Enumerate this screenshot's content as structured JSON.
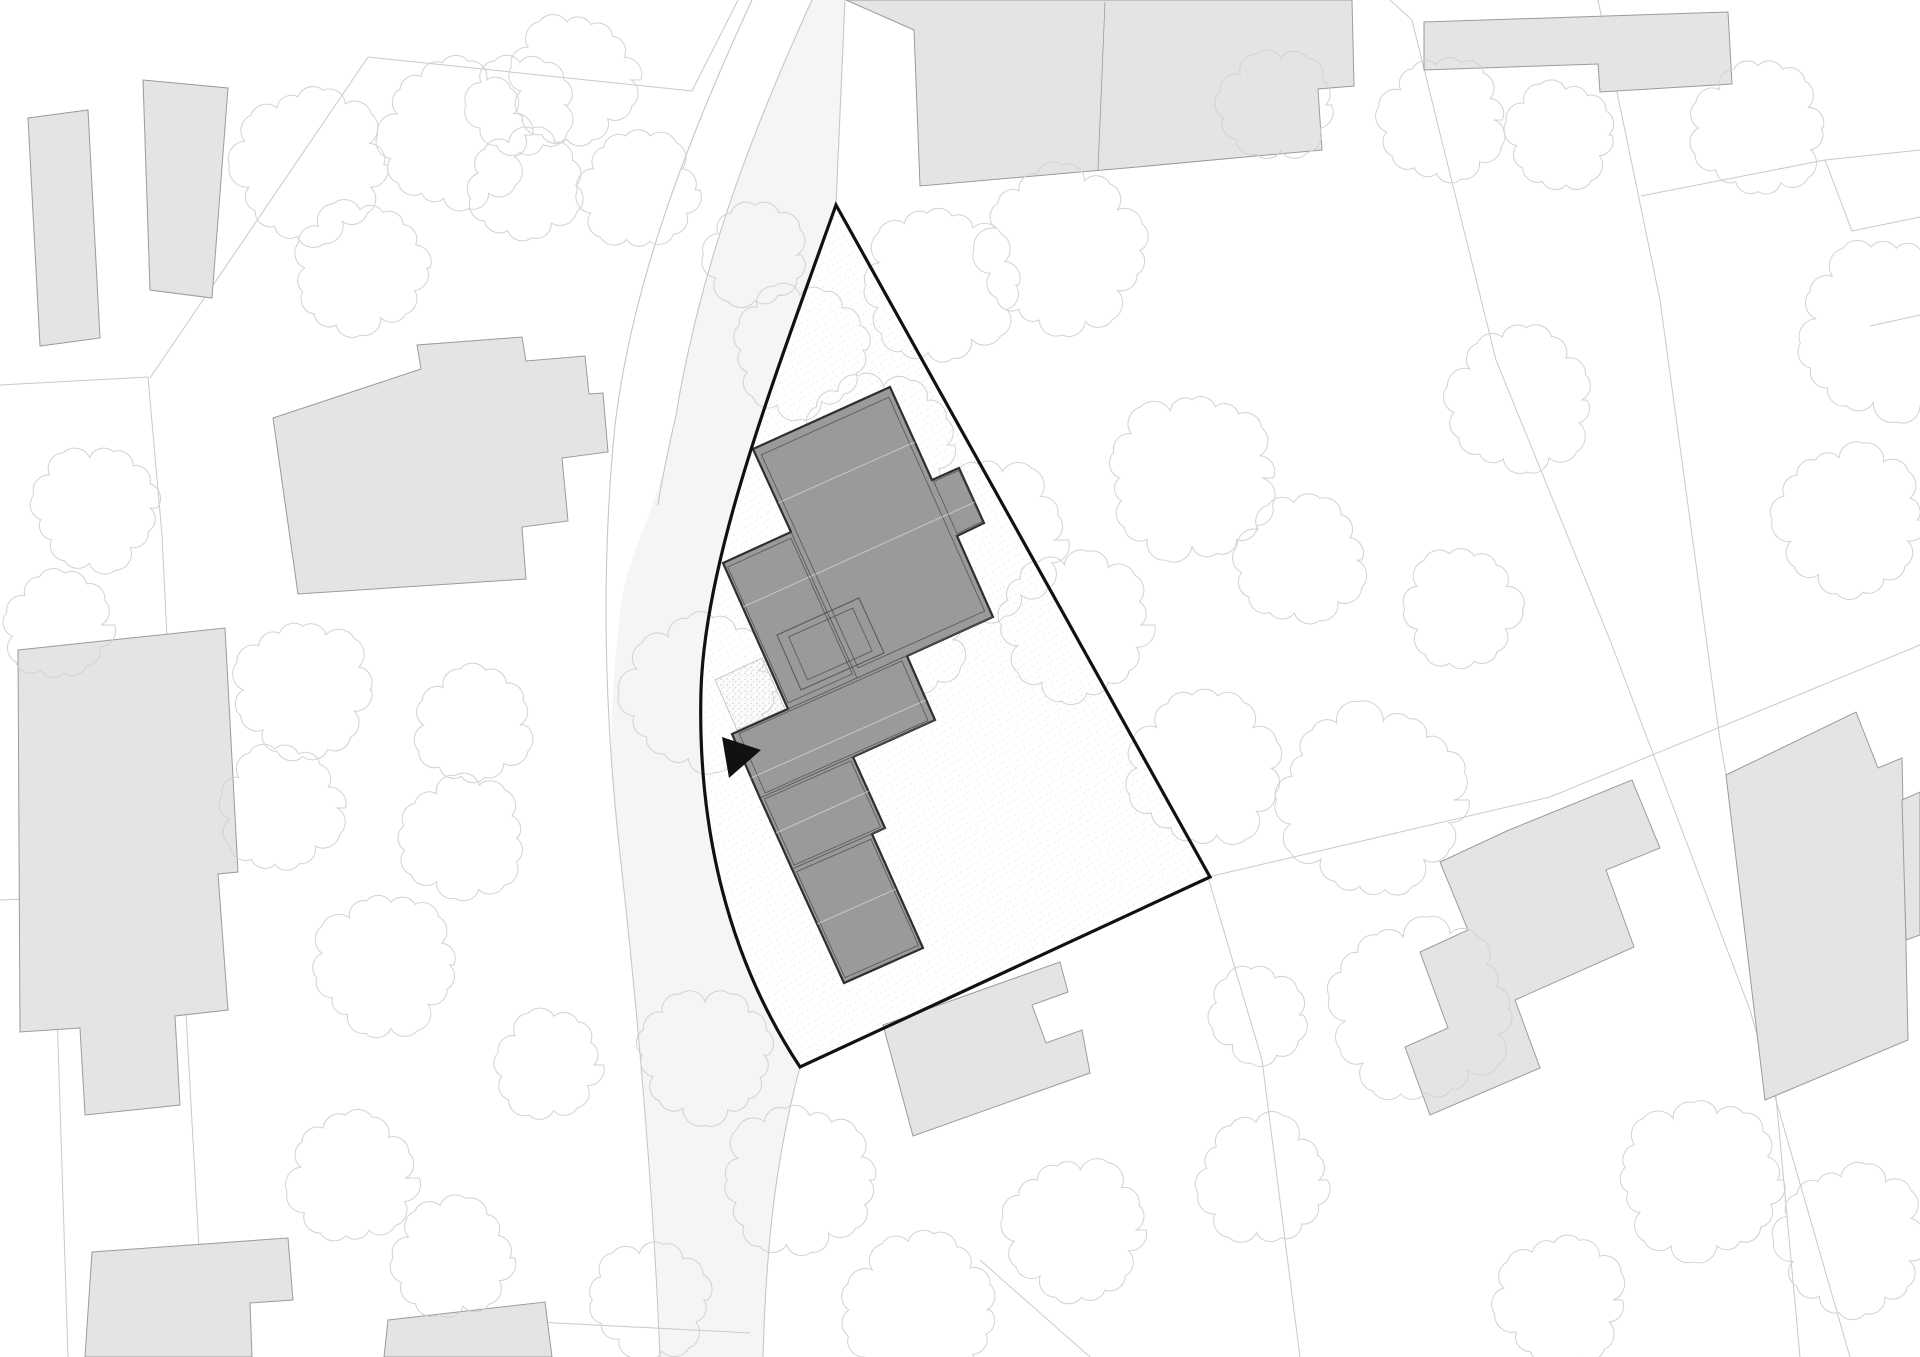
{
  "document": {
    "type": "architectural-site-plan",
    "canvas": {
      "width": 1920,
      "height": 1357
    }
  },
  "colors": {
    "background": "#ffffff",
    "road_fill": "#f5f5f5",
    "road_edge": "#c6c6c6",
    "parcel_line": "#c9c9c9",
    "context_building_fill": "#e4e4e4",
    "context_building_stroke": "#9b9b9b",
    "tree_stroke": "#d2d2d2",
    "site_boundary": "#111111",
    "main_building_fill": "#9a9a9a",
    "main_building_stroke": "#2f2f2f",
    "main_building_inner": "#555555",
    "roof_highlight": "rgba(255,255,255,0.45)",
    "stipple_dot": "#a9a9a9",
    "terrace_stroke": "#bdbdbd",
    "marker": "#111111"
  },
  "map": {
    "road": {
      "fill_path": "M 812,0 C 748,140 700,270 676,415 C 656,520 630,545 621,605 C 610,700 607,765 620,848 C 636,988 654,1180 661,1357 L 763,1357 C 766,1250 775,1160 800,1067 C 716,940 698,800 701,690 C 705,560 770,390 836,205 L 845,0 Z",
      "edge_paths": [
        "M 752,0 C 685,145 632,285 615,425 C 601,565 604,705 619,845 C 635,985 653,1180 660,1357",
        "M 812,0 C 748,140 700,270 676,415 C 668,450 662,480 658,505",
        "M 845,0 L 836,205",
        "M 800,1067 C 775,1160 766,1250 763,1357"
      ]
    },
    "parcel_lines": [
      [
        [
          368,
          57
        ],
        [
          692,
          91
        ]
      ],
      [
        [
          692,
          91
        ],
        [
          738,
          0
        ]
      ],
      [
        [
          150,
          378
        ],
        [
          368,
          57
        ]
      ],
      [
        [
          0,
          385
        ],
        [
          148,
          377
        ],
        [
          162,
          535
        ],
        [
          180,
          905
        ],
        [
          205,
          1357
        ]
      ],
      [
        [
          0,
          900
        ],
        [
          162,
          893
        ]
      ],
      [
        [
          55,
          948
        ],
        [
          68,
          1357
        ]
      ],
      [
        [
          1390,
          0
        ],
        [
          1412,
          20
        ],
        [
          1496,
          360
        ],
        [
          1610,
          640
        ],
        [
          1750,
          1010
        ],
        [
          1850,
          1357
        ]
      ],
      [
        [
          1598,
          0
        ],
        [
          1660,
          300
        ],
        [
          1720,
          740
        ],
        [
          1768,
          1010
        ],
        [
          1800,
          1357
        ]
      ],
      [
        [
          1641,
          196
        ],
        [
          1825,
          160
        ],
        [
          1920,
          150
        ]
      ],
      [
        [
          1825,
          160
        ],
        [
          1852,
          231
        ],
        [
          1920,
          217
        ]
      ],
      [
        [
          1870,
          326
        ],
        [
          1920,
          315
        ]
      ],
      [
        [
          1208,
          877
        ],
        [
          1550,
          797
        ],
        [
          1920,
          645
        ]
      ],
      [
        [
          1208,
          877
        ],
        [
          1262,
          1060
        ],
        [
          1300,
          1357
        ]
      ],
      [
        [
          980,
          1260
        ],
        [
          1090,
          1357
        ]
      ],
      [
        [
          460,
          1318
        ],
        [
          750,
          1333
        ]
      ]
    ],
    "context_buildings": [
      {
        "points": [
          [
            28,
            118
          ],
          [
            88,
            110
          ],
          [
            100,
            338
          ],
          [
            40,
            346
          ]
        ]
      },
      {
        "points": [
          [
            143,
            80
          ],
          [
            228,
            88
          ],
          [
            212,
            298
          ],
          [
            150,
            290
          ]
        ]
      },
      {
        "points": [
          [
            273,
            418
          ],
          [
            421,
            369
          ],
          [
            417,
            345
          ],
          [
            522,
            337
          ],
          [
            526,
            361
          ],
          [
            585,
            356
          ],
          [
            589,
            394
          ],
          [
            603,
            393
          ],
          [
            608,
            452
          ],
          [
            562,
            458
          ],
          [
            568,
            521
          ],
          [
            522,
            527
          ],
          [
            526,
            579
          ],
          [
            420,
            586
          ],
          [
            298,
            594
          ]
        ]
      },
      {
        "points": [
          [
            18,
            650
          ],
          [
            225,
            628
          ],
          [
            238,
            872
          ],
          [
            218,
            874
          ],
          [
            228,
            1010
          ],
          [
            175,
            1016
          ],
          [
            180,
            1105
          ],
          [
            85,
            1115
          ],
          [
            80,
            1028
          ],
          [
            20,
            1032
          ]
        ]
      },
      {
        "points": [
          [
            92,
            1252
          ],
          [
            288,
            1238
          ],
          [
            293,
            1300
          ],
          [
            250,
            1303
          ],
          [
            252,
            1357
          ],
          [
            85,
            1357
          ]
        ]
      },
      {
        "points": [
          [
            388,
            1320
          ],
          [
            545,
            1302
          ],
          [
            552,
            1357
          ],
          [
            384,
            1357
          ]
        ]
      },
      {
        "points": [
          [
            883,
            1025
          ],
          [
            1060,
            962
          ],
          [
            1068,
            992
          ],
          [
            1032,
            1005
          ],
          [
            1046,
            1043
          ],
          [
            1082,
            1030
          ],
          [
            1090,
            1073
          ],
          [
            913,
            1136
          ]
        ]
      },
      {
        "points": [
          [
            846,
            0
          ],
          [
            1352,
            0
          ],
          [
            1354,
            86
          ],
          [
            1318,
            89
          ],
          [
            1322,
            150
          ],
          [
            1126,
            168
          ],
          [
            920,
            186
          ],
          [
            914,
            30
          ]
        ]
      },
      {
        "points": [
          [
            1424,
            22
          ],
          [
            1728,
            12
          ],
          [
            1732,
            84
          ],
          [
            1600,
            92
          ],
          [
            1598,
            64
          ],
          [
            1424,
            70
          ]
        ]
      },
      {
        "points": [
          [
            1509,
            830
          ],
          [
            1632,
            780
          ],
          [
            1660,
            848
          ],
          [
            1606,
            870
          ],
          [
            1634,
            947
          ],
          [
            1515,
            1000
          ],
          [
            1540,
            1068
          ],
          [
            1430,
            1115
          ],
          [
            1405,
            1047
          ],
          [
            1448,
            1028
          ],
          [
            1420,
            952
          ],
          [
            1468,
            930
          ],
          [
            1440,
            862
          ]
        ]
      },
      {
        "points": [
          [
            1726,
            775
          ],
          [
            1856,
            712
          ],
          [
            1878,
            768
          ],
          [
            1902,
            758
          ],
          [
            1908,
            1040
          ],
          [
            1765,
            1100
          ]
        ]
      },
      {
        "points": [
          [
            1902,
            800
          ],
          [
            1920,
            792
          ],
          [
            1920,
            935
          ],
          [
            1906,
            940
          ]
        ]
      }
    ],
    "context_building_inner_lines": [
      [
        [
          1105,
          2
        ],
        [
          1098,
          170
        ]
      ]
    ],
    "trees": [
      {
        "cx": 310,
        "cy": 165,
        "r": 72
      },
      {
        "cx": 455,
        "cy": 135,
        "r": 70
      },
      {
        "cx": 360,
        "cy": 268,
        "r": 62
      },
      {
        "cx": 520,
        "cy": 105,
        "r": 48
      },
      {
        "cx": 573,
        "cy": 80,
        "r": 60
      },
      {
        "cx": 525,
        "cy": 185,
        "r": 52
      },
      {
        "cx": 638,
        "cy": 190,
        "r": 55
      },
      {
        "cx": 800,
        "cy": 350,
        "r": 62
      },
      {
        "cx": 755,
        "cy": 255,
        "r": 48
      },
      {
        "cx": 940,
        "cy": 285,
        "r": 72
      },
      {
        "cx": 1062,
        "cy": 250,
        "r": 78
      },
      {
        "cx": 878,
        "cy": 445,
        "r": 68
      },
      {
        "cx": 985,
        "cy": 540,
        "r": 75
      },
      {
        "cx": 1075,
        "cy": 625,
        "r": 70
      },
      {
        "cx": 905,
        "cy": 640,
        "r": 55
      },
      {
        "cx": 1275,
        "cy": 105,
        "r": 52
      },
      {
        "cx": 1442,
        "cy": 120,
        "r": 58
      },
      {
        "cx": 1560,
        "cy": 135,
        "r": 50
      },
      {
        "cx": 1758,
        "cy": 128,
        "r": 62
      },
      {
        "cx": 1192,
        "cy": 478,
        "r": 78
      },
      {
        "cx": 1300,
        "cy": 560,
        "r": 60
      },
      {
        "cx": 1520,
        "cy": 400,
        "r": 68
      },
      {
        "cx": 1890,
        "cy": 330,
        "r": 85
      },
      {
        "cx": 1850,
        "cy": 520,
        "r": 70
      },
      {
        "cx": 1205,
        "cy": 768,
        "r": 72
      },
      {
        "cx": 1372,
        "cy": 800,
        "r": 88
      },
      {
        "cx": 1462,
        "cy": 608,
        "r": 55
      },
      {
        "cx": 700,
        "cy": 692,
        "r": 72
      },
      {
        "cx": 95,
        "cy": 508,
        "r": 58
      },
      {
        "cx": 58,
        "cy": 625,
        "r": 50
      },
      {
        "cx": 303,
        "cy": 690,
        "r": 64
      },
      {
        "cx": 281,
        "cy": 808,
        "r": 58
      },
      {
        "cx": 473,
        "cy": 725,
        "r": 54
      },
      {
        "cx": 462,
        "cy": 838,
        "r": 58
      },
      {
        "cx": 385,
        "cy": 965,
        "r": 66
      },
      {
        "cx": 548,
        "cy": 1065,
        "r": 50
      },
      {
        "cx": 352,
        "cy": 1178,
        "r": 60
      },
      {
        "cx": 452,
        "cy": 1258,
        "r": 56
      },
      {
        "cx": 705,
        "cy": 1055,
        "r": 62
      },
      {
        "cx": 798,
        "cy": 1180,
        "r": 70
      },
      {
        "cx": 920,
        "cy": 1310,
        "r": 72
      },
      {
        "cx": 1075,
        "cy": 1230,
        "r": 66
      },
      {
        "cx": 650,
        "cy": 1300,
        "r": 55
      },
      {
        "cx": 1262,
        "cy": 1180,
        "r": 60
      },
      {
        "cx": 1420,
        "cy": 1010,
        "r": 85
      },
      {
        "cx": 1700,
        "cy": 1180,
        "r": 75
      },
      {
        "cx": 1560,
        "cy": 1300,
        "r": 60
      },
      {
        "cx": 1852,
        "cy": 1240,
        "r": 70
      },
      {
        "cx": 1258,
        "cy": 1015,
        "r": 45
      }
    ],
    "site": {
      "boundary_path": "M 836,205 L 1210,877 L 800,1067 C 716,940 698,800 701,690 C 705,560 770,390 836,205 Z",
      "boundary_width": 3.2
    },
    "main_building": {
      "outline": [
        [
          890,
          387
        ],
        [
          932,
          480
        ],
        [
          959,
          468
        ],
        [
          984,
          523
        ],
        [
          957,
          536
        ],
        [
          993,
          617
        ],
        [
          907,
          656
        ],
        [
          935,
          720
        ],
        [
          853,
          757
        ],
        [
          885,
          828
        ],
        [
          872,
          834
        ],
        [
          923,
          948
        ],
        [
          844,
          983
        ],
        [
          792,
          869
        ],
        [
          760,
          798
        ],
        [
          732,
          734
        ],
        [
          788,
          709
        ],
        [
          723,
          563
        ],
        [
          791,
          532
        ],
        [
          753,
          449
        ]
      ],
      "blocks": [
        [
          [
            890,
            387
          ],
          [
            753,
            449
          ],
          [
            857,
            678
          ],
          [
            993,
            617
          ]
        ],
        [
          [
            791,
            532
          ],
          [
            723,
            563
          ],
          [
            788,
            709
          ],
          [
            857,
            678
          ]
        ],
        [
          [
            907,
            656
          ],
          [
            732,
            734
          ],
          [
            760,
            798
          ],
          [
            935,
            720
          ]
        ],
        [
          [
            853,
            757
          ],
          [
            760,
            798
          ],
          [
            792,
            869
          ],
          [
            885,
            828
          ]
        ],
        [
          [
            872,
            834
          ],
          [
            792,
            869
          ],
          [
            844,
            983
          ],
          [
            923,
            948
          ]
        ],
        [
          [
            932,
            480
          ],
          [
            959,
            468
          ],
          [
            984,
            523
          ],
          [
            957,
            536
          ]
        ]
      ],
      "division_lines": [
        [
          [
            993,
            617
          ],
          [
            788,
            709
          ]
        ],
        [
          [
            935,
            720
          ],
          [
            760,
            798
          ]
        ],
        [
          [
            885,
            828
          ],
          [
            792,
            869
          ]
        ],
        [
          [
            791,
            532
          ],
          [
            857,
            678
          ]
        ]
      ],
      "skylight": [
        [
          859,
          598
        ],
        [
          777,
          635
        ],
        [
          801,
          690
        ],
        [
          884,
          653
        ]
      ],
      "roof_highlight_lines": [
        [
          [
            778,
            503
          ],
          [
            915,
            442
          ]
        ],
        [
          [
            743,
            607
          ],
          [
            975,
            502
          ]
        ],
        [
          [
            751,
            778
          ],
          [
            926,
            700
          ]
        ],
        [
          [
            776,
            833
          ],
          [
            869,
            791
          ]
        ],
        [
          [
            817,
            924
          ],
          [
            896,
            889
          ]
        ]
      ]
    },
    "terrace": {
      "points": [
        [
          762,
          658
        ],
        [
          715,
          680
        ],
        [
          737,
          730
        ],
        [
          785,
          709
        ]
      ]
    },
    "entrance_marker": {
      "points": [
        [
          722,
          737
        ],
        [
          761,
          750
        ],
        [
          729,
          778
        ]
      ]
    }
  }
}
